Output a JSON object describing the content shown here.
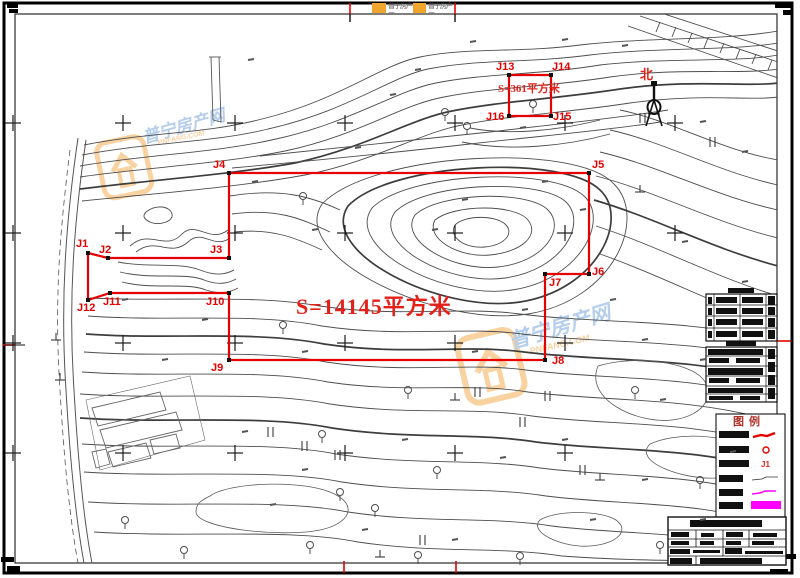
{
  "sheet_title": "地形图测绘图",
  "north": {
    "label": "北"
  },
  "logo_strip": {
    "items": [
      {
        "text": "普宁房产网"
      },
      {
        "text": "普宁房产网"
      }
    ]
  },
  "parcels": {
    "main": {
      "area_label": "S=14145平方米",
      "label_pos": {
        "x": 296,
        "y": 296
      },
      "points": [
        {
          "id": "J1",
          "x": 88,
          "y": 253,
          "lx": 76,
          "ly": 239
        },
        {
          "id": "J2",
          "x": 108,
          "y": 258,
          "lx": 99,
          "ly": 245
        },
        {
          "id": "J3",
          "x": 229,
          "y": 258,
          "lx": 210,
          "ly": 245
        },
        {
          "id": "J4",
          "x": 229,
          "y": 173,
          "lx": 213,
          "ly": 160
        },
        {
          "id": "J5",
          "x": 589,
          "y": 173,
          "lx": 592,
          "ly": 160
        },
        {
          "id": "J6",
          "x": 589,
          "y": 274,
          "lx": 592,
          "ly": 267
        },
        {
          "id": "J7",
          "x": 545,
          "y": 274,
          "lx": 549,
          "ly": 278
        },
        {
          "id": "J8",
          "x": 545,
          "y": 360,
          "lx": 552,
          "ly": 356
        },
        {
          "id": "J9",
          "x": 229,
          "y": 360,
          "lx": 211,
          "ly": 363
        },
        {
          "id": "J10",
          "x": 229,
          "y": 293,
          "lx": 206,
          "ly": 297
        },
        {
          "id": "J11",
          "x": 110,
          "y": 293,
          "lx": 103,
          "ly": 297
        },
        {
          "id": "J12",
          "x": 88,
          "y": 300,
          "lx": 77,
          "ly": 303
        }
      ]
    },
    "small": {
      "area_label": "S=361平方米",
      "label_pos": {
        "x": 498,
        "y": 84
      },
      "points": [
        {
          "id": "J13",
          "x": 509,
          "y": 75,
          "lx": 496,
          "ly": 62
        },
        {
          "id": "J14",
          "x": 551,
          "y": 75,
          "lx": 552,
          "ly": 62
        },
        {
          "id": "J15",
          "x": 551,
          "y": 116,
          "lx": 553,
          "ly": 112
        },
        {
          "id": "J16",
          "x": 509,
          "y": 116,
          "lx": 486,
          "ly": 112
        }
      ]
    }
  },
  "legend": {
    "title": "图例",
    "rows": [
      {
        "symbol": "red-line"
      },
      {
        "symbol": "red-circle"
      },
      {
        "symbol": "red-text",
        "text": "J1"
      },
      {
        "symbol": "gray-line"
      },
      {
        "symbol": "magenta-line"
      },
      {
        "symbol": "magenta-fill"
      }
    ]
  },
  "tables": {
    "upper": {
      "redacted": true,
      "rows": 4
    },
    "lower": {
      "redacted": true,
      "rows": 6
    }
  },
  "title_block": {
    "redacted": true,
    "rows": 5
  },
  "watermarks": [
    {
      "text": "普宁房产网",
      "sub": "PNFANG.COM",
      "x": 88,
      "y": 132,
      "rot": -12,
      "size": 17
    },
    {
      "text": "普宁房产网",
      "sub": "PNFANG.COM",
      "x": 448,
      "y": 326,
      "rot": -13,
      "size": 21
    }
  ],
  "grid": {
    "xs": [
      13,
      123,
      235,
      345,
      455,
      565,
      675
    ],
    "ys": [
      123,
      233,
      343,
      453
    ]
  },
  "colors": {
    "red": "#e60000",
    "magenta": "#ff00ff",
    "contour": "#4d4d4d",
    "orange": "#f2a52e",
    "blue": "#5b93d5",
    "black": "#111111"
  }
}
